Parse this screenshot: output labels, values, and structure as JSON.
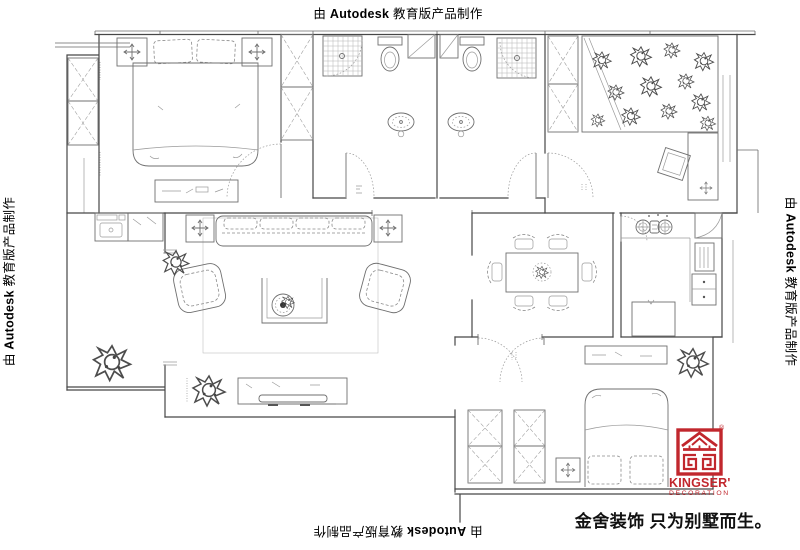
{
  "watermark": {
    "prefix": "由 ",
    "brand": "Autodesk",
    "suffix": " 教育版产品制作"
  },
  "brand": {
    "registered": "®",
    "name": "KINGSER'",
    "subtitle": "DECORATION",
    "slogan": "金舍装饰 只为别墅而生。",
    "color": "#c1272d"
  },
  "drawing": {
    "background": "#ffffff",
    "wall_line_color": "#474747",
    "furniture_line_color": "#6f6f6f",
    "light_line_color": "#9a9a9a",
    "watermark_text_color": "#000000",
    "slogan_text_color": "#111111"
  }
}
